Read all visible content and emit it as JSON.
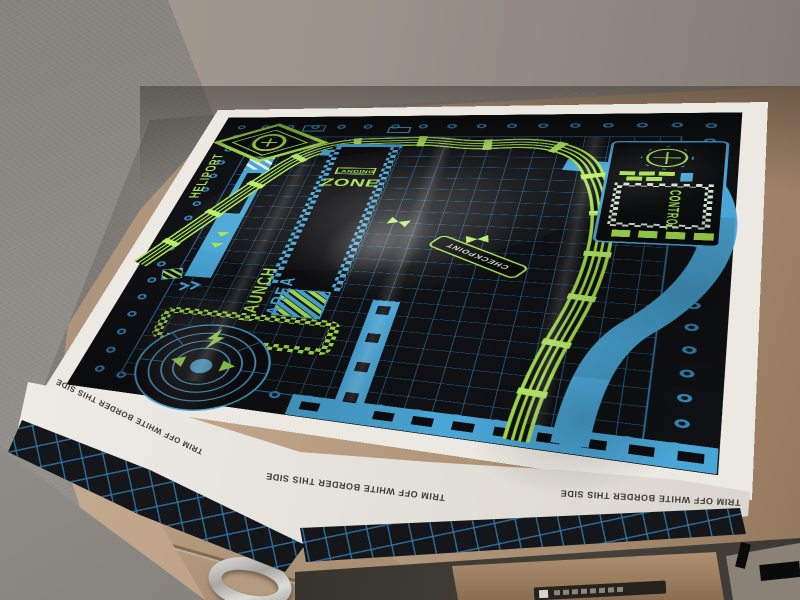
{
  "mat": {
    "trim_notice": "TRIM OFF WHITE BORDER THIS SIDE",
    "heliport": {
      "label": "HELIPORT"
    },
    "landing_zone": {
      "word_top": "LANDING",
      "word_main": "ZONE"
    },
    "launch_area": {
      "word_top": "LAUNCH",
      "word_bottom": "AREA"
    },
    "control_panel": {
      "label": "CONTROL"
    },
    "checkpoint": {
      "label": "CHECKPOINT"
    },
    "colors": {
      "paper_white": "#ece8e2",
      "field_black": "#101114",
      "grid_blue": "#2f76aa",
      "road_blue": "#4aa6d6",
      "track_green": "#a6e24e",
      "tie_green": "#b9ef66"
    }
  },
  "environment": {
    "wall_color": "#8f8c88",
    "desk_color": "#b89e83",
    "under_desk_color": "#3e3a35",
    "box_color": "#a3886a"
  }
}
